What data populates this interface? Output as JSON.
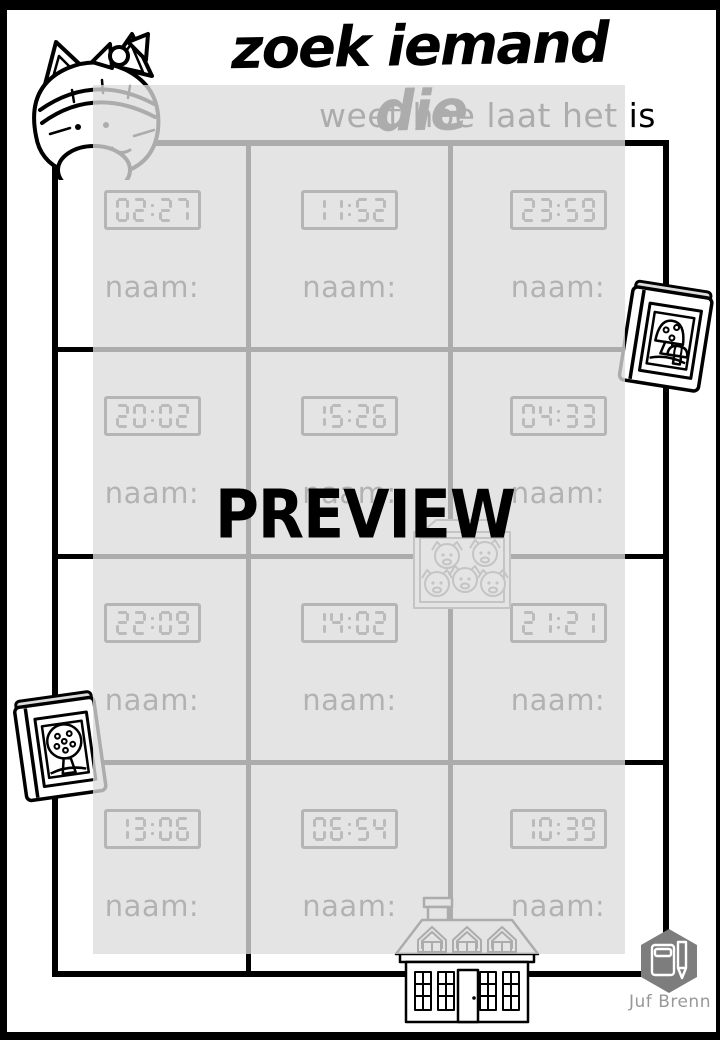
{
  "page": {
    "title": "zoek iemand die",
    "subtitle": "weet hoe laat het is",
    "watermark": "PREVIEW",
    "name_label": "naam:",
    "times": [
      [
        "02:27",
        "11:52",
        "23:59"
      ],
      [
        "20:02",
        "15:26",
        "04:33"
      ],
      [
        "22:09",
        "14:02",
        "21:21"
      ],
      [
        "13:06",
        "06:54",
        "10:39"
      ]
    ],
    "brand": "Juf Brenn",
    "icons": [
      "cat-icon",
      "mushroom-book-icon",
      "fox-box-icon",
      "tree-book-icon",
      "house-icon",
      "book-pencil-logo-icon"
    ],
    "colors": {
      "frame": "#000000",
      "overlay": "rgba(221,221,221,0.78)",
      "brand_hexagon": "#7d7d7d",
      "brand_text": "#989898",
      "clipart_gray": "#6f6f6f"
    }
  }
}
